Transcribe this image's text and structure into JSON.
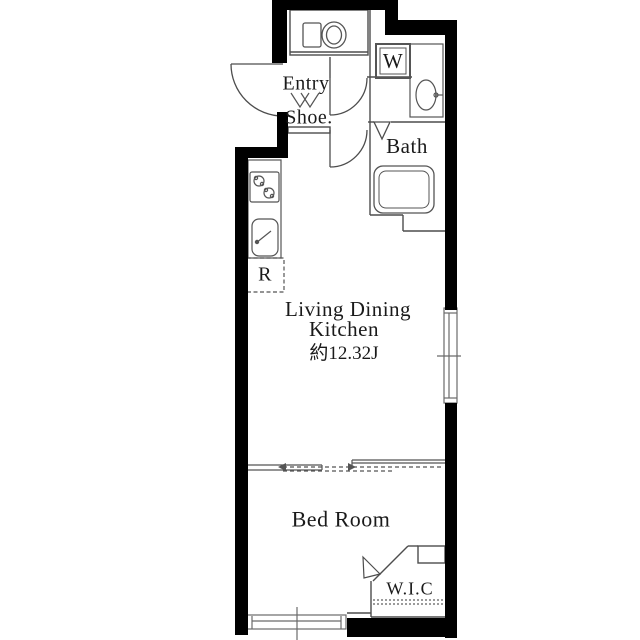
{
  "floor_plan": {
    "rooms": {
      "entry": {
        "label": "Entry"
      },
      "shoe": {
        "label": "Shoe."
      },
      "washer": {
        "label": "W"
      },
      "bath": {
        "label": "Bath"
      },
      "ldk": {
        "label_line1": "Living Dining",
        "label_line2": "Kitchen",
        "size": "約12.32J"
      },
      "bedroom": {
        "label": "Bed Room"
      },
      "wic": {
        "label": "W.I.C"
      },
      "refrigerator": {
        "label": "R"
      }
    },
    "icons": {
      "toilet": "toilet-icon",
      "washing_machine": "washing-machine-icon",
      "bathroom_sink": "bathroom-sink-icon",
      "bathtub": "bathtub-icon",
      "stove": "stove-icon",
      "kitchen_sink": "kitchen-sink-icon",
      "entry_door": "entry-door-icon",
      "hall_door": "hall-door-icon",
      "ldk_door": "ldk-door-icon",
      "bath_folding_door": "bath-folding-door-icon",
      "wic_door": "wic-door-icon",
      "sliding_door": "sliding-door-icon",
      "window_right": "window-right-icon",
      "window_bottom": "window-bottom-icon",
      "shoe_shelf": "shoe-shelf-icon",
      "refrigerator_space": "refrigerator-box"
    },
    "colors": {
      "wall": "#000000",
      "line": "#4d4d4d",
      "fixture": "#555555",
      "text": "#1a1a1a",
      "background": "#ffffff"
    }
  }
}
